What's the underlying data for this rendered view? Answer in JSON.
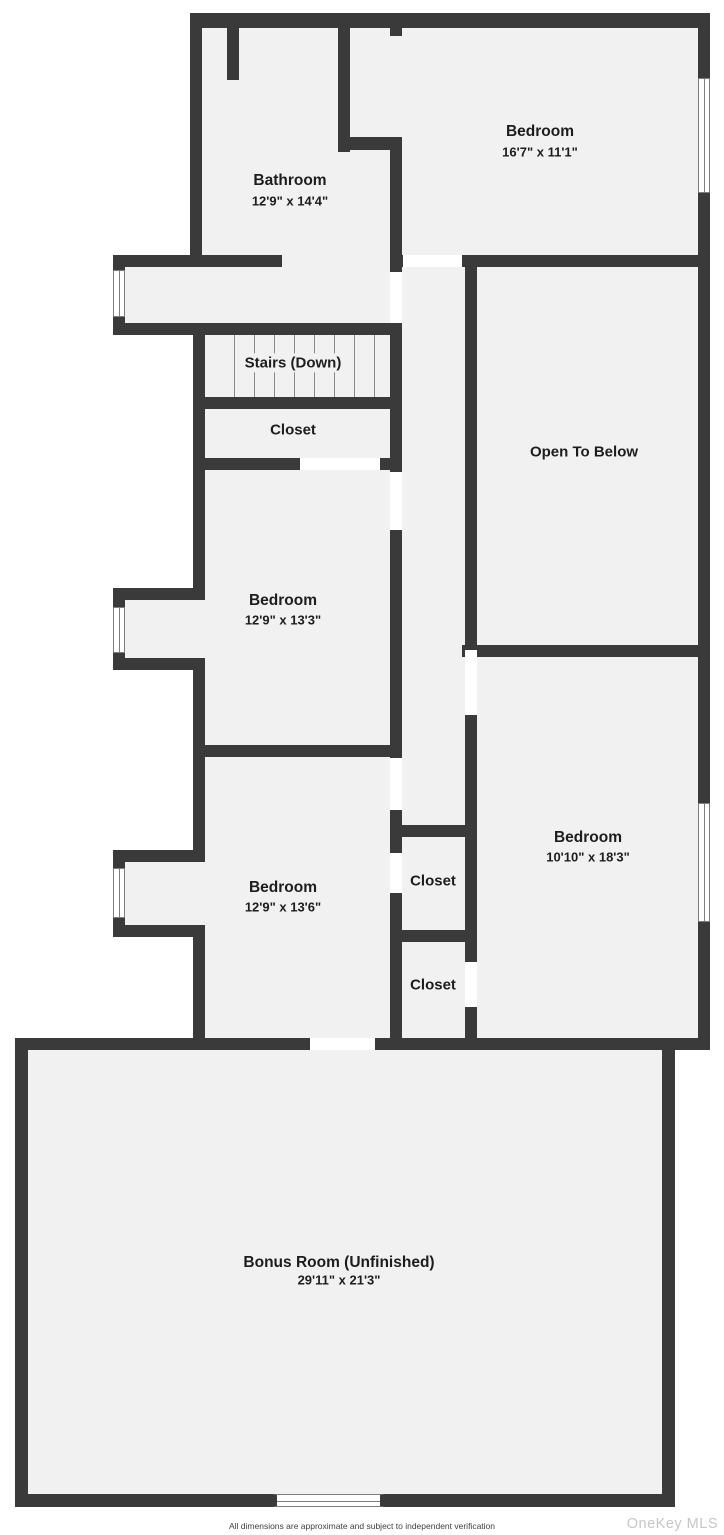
{
  "rooms": {
    "bathroom": {
      "name": "Bathroom",
      "dims": "12'9\" x 14'4\""
    },
    "bedroom_top": {
      "name": "Bedroom",
      "dims": "16'7\" x 11'1\""
    },
    "stairs": {
      "name": "Stairs (Down)"
    },
    "closet_upper": {
      "name": "Closet"
    },
    "open_to_below": {
      "name": "Open To Below"
    },
    "bedroom_mid": {
      "name": "Bedroom",
      "dims": "12'9\" x 13'3\""
    },
    "bedroom_lower": {
      "name": "Bedroom",
      "dims": "12'9\" x 13'6\""
    },
    "closet_1": {
      "name": "Closet"
    },
    "closet_2": {
      "name": "Closet"
    },
    "bedroom_right": {
      "name": "Bedroom",
      "dims": "10'10\" x 18'3\""
    },
    "bonus_room": {
      "name": "Bonus Room (Unfinished)",
      "dims": "29'11\" x 21'3\""
    }
  },
  "footer": {
    "disclaimer": "All dimensions are approximate and subject to independent verification",
    "watermark": "OneKey MLS"
  },
  "colors": {
    "wall": "#3a3a3a",
    "room_fill": "#f1f1f1",
    "background": "#ffffff",
    "label_text": "#1d1d1d",
    "watermark": "#c6c6c6"
  }
}
